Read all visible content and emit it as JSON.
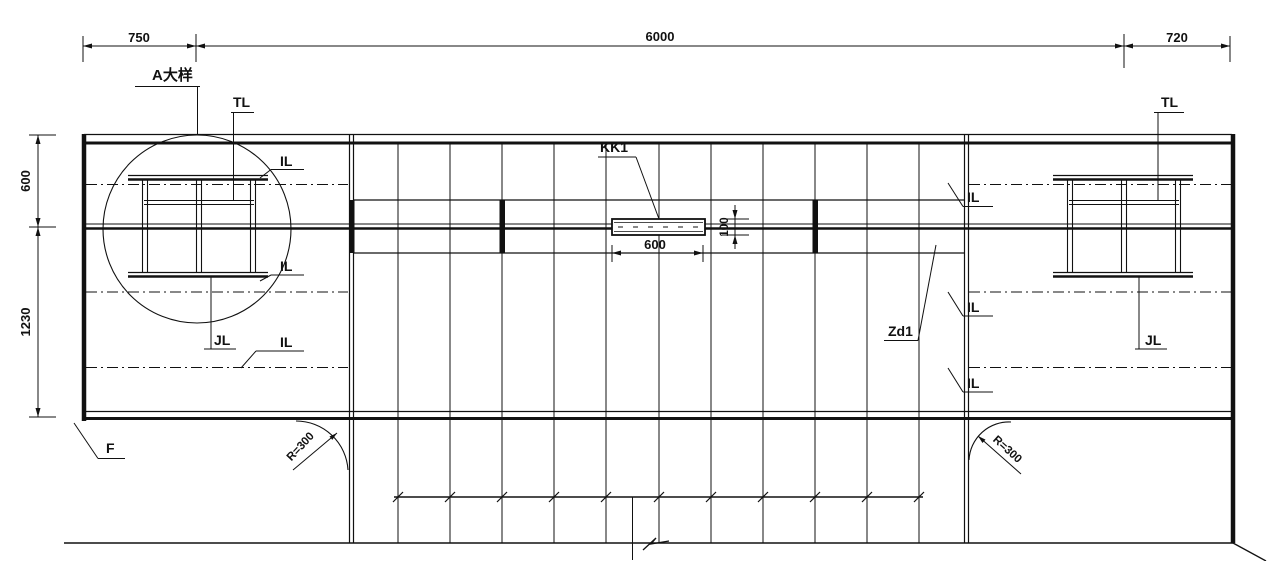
{
  "drawing": {
    "dimensions": {
      "top_left": "750",
      "top_middle": "6000",
      "top_right": "720",
      "side_upper": "600",
      "side_lower": "1230",
      "kk1_width": "600",
      "kk1_height": "100"
    },
    "labels": {
      "detail_a": "A大样",
      "tl": "TL",
      "il": "IL",
      "jl": "JL",
      "kk1": "KK1",
      "zd1": "Zd1",
      "f": "F",
      "radius": "R=300"
    },
    "colors": {
      "line": "#111111",
      "background": "#ffffff"
    }
  }
}
